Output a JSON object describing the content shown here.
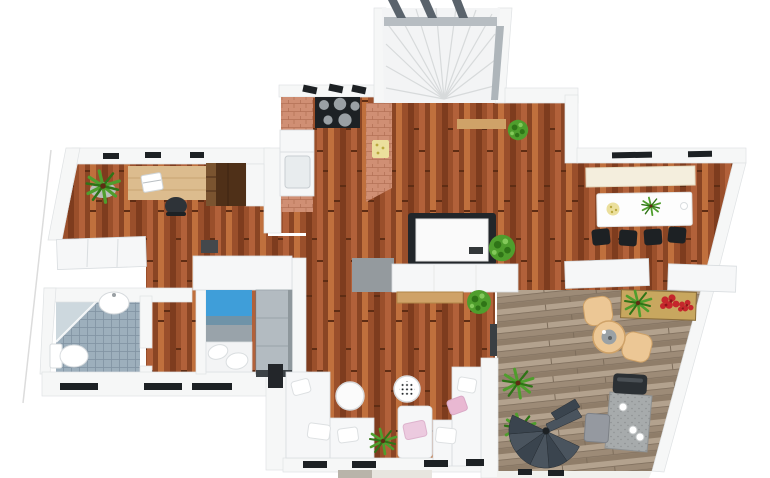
{
  "scene": {
    "description": "3D top-down apartment floor plan render",
    "rooms": [
      {
        "id": "office",
        "label": "office-study",
        "items": [
          "wood-desk",
          "laptop",
          "office-chair",
          "potted-plant",
          "white-cabinet"
        ]
      },
      {
        "id": "hallway",
        "label": "hallway",
        "items": [
          "dark-wardrobe",
          "door-threshold"
        ]
      },
      {
        "id": "kitchen",
        "label": "kitchen",
        "items": [
          "black-cooktop-5-burners",
          "range-hood-mounts",
          "sink-unit",
          "terracotta-counter-left",
          "terracotta-counter-right",
          "cutting-board"
        ]
      },
      {
        "id": "staircase",
        "label": "winder-staircase",
        "items": [
          "white-fan-steps",
          "landing-slab",
          "railing-beams",
          "side-rail",
          "wood-shelf",
          "potted-plant"
        ]
      },
      {
        "id": "dining-room",
        "label": "dining-room",
        "items": [
          "white-dining-table",
          "black-chair",
          "black-chair",
          "black-chair",
          "black-chair",
          "cream-window-bench",
          "fruit-plate",
          "table-plant",
          "cup"
        ]
      },
      {
        "id": "main-room",
        "label": "open-living-area",
        "items": [
          "table-dark-frame-white-top",
          "white-sideboard",
          "wood-bench",
          "gray-rug",
          "round-shrub",
          "round-shrub",
          "terrace-door-threshold"
        ]
      },
      {
        "id": "bedroom",
        "label": "bedroom",
        "items": [
          "single-bed-blue-headboard",
          "pillows",
          "gray-closet",
          "wall-closet-band"
        ]
      },
      {
        "id": "bathroom",
        "label": "bathroom",
        "items": [
          "tiled-floor",
          "corner-shower-glass-partition",
          "washbasin",
          "toilet"
        ]
      },
      {
        "id": "living-room",
        "label": "living-room",
        "items": [
          "corner-sofa-left",
          "corner-sofa-right",
          "armchair",
          "round-coffee-table",
          "dotted-side-table",
          "floor-plant",
          "tv-panel",
          "pink-pillows",
          "white-pillows"
        ]
      },
      {
        "id": "terrace",
        "label": "terrace-deck",
        "items": [
          "round-tan-table",
          "tan-chair",
          "tan-chair",
          "planter-box",
          "ornamental-grass",
          "red-flowers",
          "palm-plant",
          "palm-plant",
          "spiral-staircase",
          "granite-outdoor-table",
          "dark-outdoor-chair",
          "gray-outdoor-chair",
          "cups"
        ]
      }
    ],
    "counts": {
      "dining_chairs": 4,
      "sofas": 2,
      "terrace_tan_chairs": 2,
      "palm_plants": 2,
      "cooktop_burners": 5
    }
  },
  "palette": {
    "background": "#ffffff",
    "wall": "#f6f7f7",
    "wall_edge": "#dfe2e4",
    "white_obj": "#f6f7f8",
    "obj_edge": "#d9dde0",
    "wood1": "#9a4f2b",
    "wood2": "#7e3c1e",
    "wood3": "#b2613a",
    "wood4": "#8a4524",
    "wood5": "#c0703d",
    "wood_seam": "#5f2d14",
    "deck1": "#b3a28e",
    "deck2": "#9d8b77",
    "deck3": "#8f7d69",
    "deck_seam": "#7d6d5b",
    "deck_rail": "#f1f1ee",
    "brick": "#d08f74",
    "brick_line": "#b57257",
    "tile": "#9dafbc",
    "tile_line": "#8193a2",
    "shower": "#cdd8de",
    "bed_blue": "#3f9ed9",
    "bed_teal": "#6f93a8",
    "bed_gray": "#99a3aa",
    "closet": "#b3bbc1",
    "closet_edge": "#9aa3a9",
    "plant": "#4f9e2d",
    "plant_dark": "#2f7417",
    "plant_light": "#83c95a",
    "flower_red": "#c5262c",
    "flower_dark": "#8e1418",
    "tan": "#ecc795",
    "tan_dark": "#cfa268",
    "desk": "#dcbc8e",
    "desk_grain": "#c9a572",
    "wardrobe": "#4f3018",
    "wardrobe_light": "#7a5430",
    "black": "#1d2124",
    "beam": "#5a636c",
    "landing": "#b7bdc2",
    "rail": "#aeb5ba",
    "stair_white": "#f3f4f5",
    "step_line": "#d7dadb",
    "spiral_a": "#4a545e",
    "spiral_b": "#3a444e",
    "spiral_edge": "#272e35",
    "granite": "#a7abac",
    "granite_dot": "#8e9192",
    "rug": "#949a9e",
    "cream": "#f4eedd",
    "cream_edge": "#e4d9bf",
    "yellow": "#ebdf9c",
    "yellow_dot": "#bba93f",
    "pink": "#eccadf",
    "pink2": "#e9b8d2",
    "balcony1": "#b9b4aa",
    "balcony2": "#e7e5df",
    "outline_faint": "#dcdcdc"
  }
}
